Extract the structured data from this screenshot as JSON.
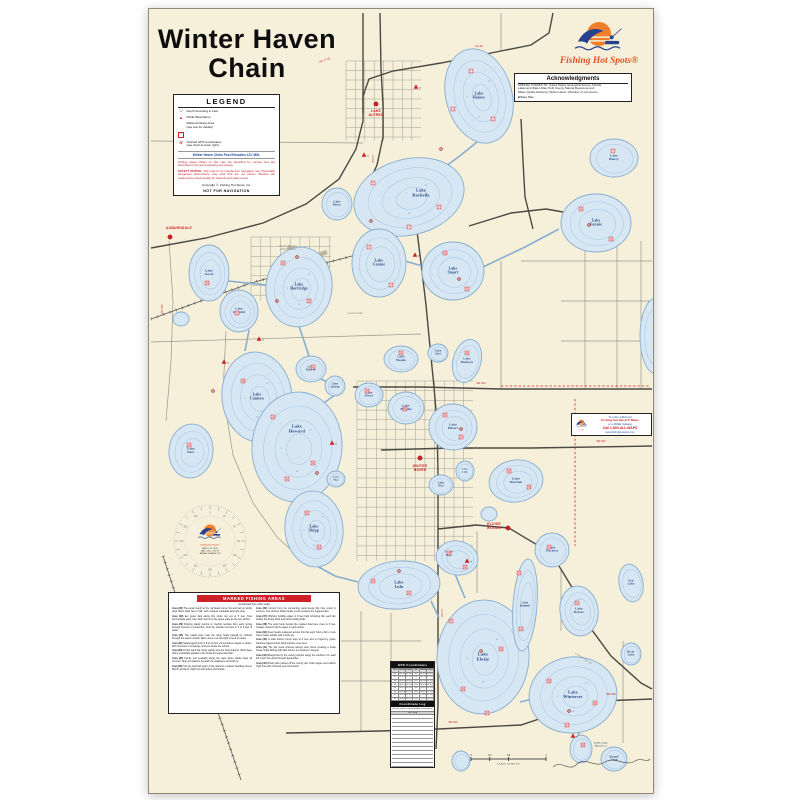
{
  "title": {
    "line1": "Winter Haven",
    "line2": "Chain"
  },
  "brand": {
    "name": "Fishing Hot Spots®"
  },
  "colors": {
    "accent_red": "#cf2027",
    "navy": "#1c3f77",
    "lake_fill": "#d7e6f3",
    "lake_stroke": "#86aecf",
    "contour": "#abc8e1",
    "cream": "#f6f0da",
    "brand_orange": "#ef7f2a",
    "brand_blue": "#27418e"
  },
  "legend": {
    "title": "LEGEND",
    "items": [
      {
        "icon": "sounding-icon",
        "label": "Depth Sounding in Feet"
      },
      {
        "icon": "boat-ramp-icon",
        "label": "Public Boat Ramp"
      },
      {
        "icon": "fishing-area-icon",
        "label": "Marked Fishing Area\n(see text for details)"
      },
      {
        "icon": "gps-point-icon",
        "label": "Charted GPS Coordinates\n(see chart at lower right)"
      }
    ],
    "pool": "Winter Haven Chain Pool Elevation 131' MSL",
    "note": "Fishing areas shown on this map are identified by number and are described in the accompanying text panels.",
    "safety_label": "SAFETY NOTICE:",
    "safety": " This map is not intended for navigation use. Potentially dangerous obstructions may exist that are not shown. Boaters are cautioned to check locally for hazards and water levels.",
    "copyright": "Copyright ©, Fishing Hot Spots, Inc.",
    "not_for_navigation": "NOT FOR NAVIGATION"
  },
  "acknowledgments": {
    "title": "Acknowledgments",
    "lines": [
      "SPECIAL THANKS TO: United States Geological Survey; Florida",
      "Lakes and Water Atlas; Polk County Natural Resources and",
      "Water Quality Divisions; Winter Haven Chamber of Commerce."
    ],
    "bullet": "■ Base Map"
  },
  "order_box": {
    "lines": [
      "To order additional",
      "Fishing Hot Spots® Maps",
      "or a FREE Catalog",
      "Call 1-800-ALL-MAPS",
      "www.fishinghotspots.com"
    ]
  },
  "compass": {
    "degrees": [
      "0",
      "30",
      "60",
      "90",
      "120",
      "150",
      "180",
      "210",
      "240",
      "270",
      "300",
      "330"
    ],
    "lines": [
      "MAP IS U.S. GRID",
      "MAG. DECL. 4°30' W",
      "ANNUAL CHANGE 2' W"
    ]
  },
  "scale_bar": {
    "caption": "SCALE IN MILES",
    "ticks": [
      "0",
      "1/4",
      "1/2",
      "1"
    ]
  },
  "marked_areas": {
    "header": "MARKED FISHING AREAS",
    "note": "(Continued from other side)",
    "paragraphs": [
      {
        "id": "Area (28)",
        "text": "The canal mouth at the northeast corner funnels bait on windy days. Bass stack here in fall; work a lipless crankbait along the drop."
      },
      {
        "id": "Area (29)",
        "text": "Eel grass flats along this shore top out at 5 feet. Toss spinnerbaits early, then pitch worms to the grass edge as the sun climbs."
      },
      {
        "id": "Area (30)",
        "text": "Flipping plastic worms or crayfish replicas from early spring through summer is productive. Fish the outside reed line in 4 to 6 feet of water."
      },
      {
        "id": "Area (31)",
        "text": "The cattail point near the ramp holds bluegill on crickets through the warm months. Bass move in at first light to feed on shad."
      },
      {
        "id": "Area (32)",
        "text": "Submerged brush in 8 to 10 feet concentrates crappie in winter. Drift minnows or small jigs until you locate the school."
      },
      {
        "id": "Area (33)",
        "text": "A hard sand bar drops quickly into the boat channel. Work deep diving crankbaits parallel to the break for suspended fish."
      },
      {
        "id": "Area (34)",
        "text": "Docks and seawalls along the west shore shade bass all summer. Skip soft plastics beneath the walkways and hold on."
      },
      {
        "id": "Area (35)",
        "text": "The lily pad field south of the island is a classic bedding area in March and April. Sight fish with tubes and lizards."
      },
      {
        "id": "Area (36)",
        "text": "Current from the connecting canal keeps this hole cooler in summer. Live shiners drifted under a cork produce the biggest bass."
      },
      {
        "id": "Area (37)",
        "text": "Offshore hydrilla edges in 9 feet hold schooling fish each fall. Follow the diving birds and throw rattling baits."
      },
      {
        "id": "Area (38)",
        "text": "The spoil bank beside the marked boat lane rises to 3 feet. Crappie suspend off its edges in early winter."
      },
      {
        "id": "Area (39)",
        "text": "Reed heads scattered across this flat each hold a fish or two. Cover water quickly with a swim jig."
      },
      {
        "id": "Area (40)",
        "text": "A shell bottom hump tops at 6 feet and is ringed by grass. Carolina rigged worms fished slowly score here."
      },
      {
        "id": "Area (41)",
        "text": "The old creek channel swings near shore creating a sharp break. Night fishing with dark worms is excellent in August."
      },
      {
        "id": "Area (42)",
        "text": "Bluegill bed in the sandy pockets along the southern rim each full moon from April through September."
      },
      {
        "id": "Area (43)",
        "text": "Brush piles placed off the county pier hold crappie and catfish. Tight line with minnows near the bottom."
      }
    ]
  },
  "gps": {
    "header": "GPS Coordinates",
    "columns": [
      "Sym",
      "Latitude",
      "Longitude",
      "Sym",
      "Latitude",
      "Longitude"
    ],
    "rows": [
      [
        "W1",
        "28°07.42'",
        "81°43.11'",
        "W9",
        "28°02.33'",
        "81°42.08'"
      ],
      [
        "W2",
        "28°06.91'",
        "81°42.57'",
        "W10",
        "28°01.87'",
        "81°41.95'"
      ],
      [
        "W3",
        "28°06.30'",
        "81°44.02'",
        "W11",
        "28°01.42'",
        "81°43.36'"
      ],
      [
        "W4",
        "28°05.78'",
        "81°41.66'",
        "W12",
        "28°00.98'",
        "81°42.71'"
      ],
      [
        "W5",
        "28°05.12'",
        "81°43.48'",
        "W13",
        "28°00.55'",
        "81°41.27'"
      ],
      [
        "W6",
        "28°04.66'",
        "81°42.19'",
        "W14",
        "28°00.12'",
        "81°42.90'"
      ],
      [
        "W7",
        "28°03.89'",
        "81°44.25'",
        "W15",
        "27°59.67'",
        "81°41.58'"
      ],
      [
        "W8",
        "28°03.21'",
        "81°43.74'",
        "W16",
        "27°59.20'",
        "81°42.33'"
      ]
    ],
    "log_header": "Coordinate Log",
    "log_note": "(use this space to record additional coordinates)",
    "log_column": "Lat / Long",
    "blank_rows": 13
  },
  "map": {
    "depth_labels": [
      "5",
      "10",
      "15"
    ],
    "lakes": [
      {
        "L": [
          "Lake",
          "Haines"
        ],
        "x": 330,
        "y": 87,
        "rx": 33,
        "ry": 48,
        "rot": -15,
        "c": 3
      },
      {
        "L": [
          "Lake",
          "Henry"
        ],
        "x": 465,
        "y": 149,
        "rx": 24,
        "ry": 19,
        "c": 1,
        "fs": 3.2
      },
      {
        "L": [
          "Lake",
          "Rochelle"
        ],
        "x": 260,
        "y": 188,
        "rx": 56,
        "ry": 38,
        "rot": -14,
        "c": 3,
        "fs": 4.2,
        "lx": 272,
        "ly": 184
      },
      {
        "L": [
          "Lake",
          "Conine"
        ],
        "x": 230,
        "y": 254,
        "rx": 27,
        "ry": 34,
        "c": 2
      },
      {
        "L": [
          "Lake",
          "Smart"
        ],
        "x": 304,
        "y": 262,
        "rx": 31,
        "ry": 29,
        "c": 2
      },
      {
        "L": [
          "Lake",
          "Fannie"
        ],
        "x": 447,
        "y": 214,
        "rx": 35,
        "ry": 29,
        "c": 2
      },
      {
        "L": [
          "Lake",
          "Pansy"
        ],
        "x": 188,
        "y": 195,
        "rx": 15,
        "ry": 16,
        "c": 1,
        "fs": 2.8
      },
      {
        "L": [
          "Lake",
          "Jessie"
        ],
        "x": 60,
        "y": 264,
        "rx": 20,
        "ry": 28,
        "c": 2,
        "fs": 3.2
      },
      {
        "L": [
          "Lake",
          "Idylwild"
        ],
        "x": 90,
        "y": 302,
        "rx": 19,
        "ry": 21,
        "c": 2,
        "fs": 3
      },
      {
        "L": [
          "Lake",
          "Hartridge"
        ],
        "x": 150,
        "y": 278,
        "rx": 33,
        "ry": 40,
        "rot": 8,
        "c": 3
      },
      {
        "L": [
          "Lake",
          "Cannon"
        ],
        "x": 108,
        "y": 388,
        "rx": 35,
        "ry": 45,
        "rot": -6,
        "c": 3
      },
      {
        "L": [
          "Lake",
          "Mirror"
        ],
        "x": 162,
        "y": 360,
        "rx": 15,
        "ry": 13,
        "c": 1,
        "fs": 2.8
      },
      {
        "L": [
          "Lake",
          "Spring"
        ],
        "x": 186,
        "y": 377,
        "rx": 10,
        "ry": 10,
        "c": 1,
        "fs": 2.6
      },
      {
        "L": [
          "Lake",
          "Silver"
        ],
        "x": 220,
        "y": 386,
        "rx": 14,
        "ry": 12,
        "c": 1,
        "fs": 2.8
      },
      {
        "L": [
          "Lake",
          "Howard"
        ],
        "x": 148,
        "y": 438,
        "rx": 45,
        "ry": 55,
        "rot": 4,
        "c": 3,
        "fs": 4.2,
        "ly": 420
      },
      {
        "L": [
          "Lake",
          "Maude"
        ],
        "x": 252,
        "y": 350,
        "rx": 17,
        "ry": 13,
        "c": 1,
        "fs": 2.9
      },
      {
        "L": [
          "Lake",
          "Idyl"
        ],
        "x": 289,
        "y": 344,
        "rx": 10,
        "ry": 9,
        "c": 1,
        "fs": 2.6
      },
      {
        "L": [
          "Lake",
          "Buckeye"
        ],
        "x": 318,
        "y": 352,
        "rx": 14,
        "ry": 22,
        "rot": 15,
        "c": 1,
        "fs": 2.9
      },
      {
        "L": [
          "Lake",
          "Martha"
        ],
        "x": 257,
        "y": 399,
        "rx": 18,
        "ry": 16,
        "c": 1,
        "fs": 3
      },
      {
        "L": [
          "Lake",
          "Elbert"
        ],
        "x": 304,
        "y": 418,
        "rx": 24,
        "ry": 23,
        "c": 2,
        "fs": 3.2
      },
      {
        "L": [
          "Lake",
          "Link"
        ],
        "x": 316,
        "y": 462,
        "rx": 9,
        "ry": 10,
        "c": 1,
        "fs": 2.5
      },
      {
        "L": [
          "Lake",
          "Otis"
        ],
        "x": 292,
        "y": 476,
        "rx": 12,
        "ry": 10,
        "c": 1,
        "fs": 2.6
      },
      {
        "L": [
          "Lake",
          "Mariam"
        ],
        "x": 367,
        "y": 472,
        "rx": 27,
        "ry": 21,
        "rot": -8,
        "c": 2,
        "fs": 3.2
      },
      {
        "L": [
          "Lake",
          "Shipp"
        ],
        "x": 165,
        "y": 520,
        "rx": 29,
        "ry": 38,
        "rot": -6,
        "c": 3
      },
      {
        "L": [
          "Lake",
          "May"
        ],
        "x": 187,
        "y": 470,
        "rx": 9,
        "ry": 8,
        "c": 1,
        "fs": 2.5
      },
      {
        "L": [
          "Lake",
          "Lulu"
        ],
        "x": 250,
        "y": 576,
        "rx": 41,
        "ry": 24,
        "rot": -4,
        "c": 2,
        "fs": 3.8
      },
      {
        "L": [
          "Lake",
          "Roy"
        ],
        "x": 308,
        "y": 549,
        "rx": 21,
        "ry": 17,
        "rot": 10,
        "c": 2,
        "fs": 3,
        "lx": 300,
        "ly": 545
      },
      {
        "L": [
          "Lake",
          "Eloise"
        ],
        "x": 334,
        "y": 648,
        "rx": 46,
        "ry": 57,
        "rot": 3,
        "c": 4,
        "fs": 4.4
      },
      {
        "L": [
          "Lake",
          "Summit"
        ],
        "x": 376,
        "y": 596,
        "rx": 12,
        "ry": 46,
        "rot": 4,
        "c": 2,
        "fs": 2.7
      },
      {
        "L": [
          "Lake",
          "Florence"
        ],
        "x": 403,
        "y": 541,
        "rx": 17,
        "ry": 17,
        "c": 1,
        "fs": 2.8
      },
      {
        "L": [
          "Lake",
          "Dexter"
        ],
        "x": 430,
        "y": 602,
        "rx": 19,
        "ry": 25,
        "rot": -8,
        "c": 2,
        "fs": 3
      },
      {
        "L": [
          "Ned",
          "Lake"
        ],
        "x": 482,
        "y": 574,
        "rx": 12,
        "ry": 19,
        "rot": -10,
        "c": 1,
        "fs": 2.7
      },
      {
        "L": [
          "River",
          "Lake"
        ],
        "x": 482,
        "y": 645,
        "rx": 10,
        "ry": 11,
        "c": 1,
        "fs": 2.6
      },
      {
        "L": [
          "Lake",
          "Winterset"
        ],
        "x": 424,
        "y": 686,
        "rx": 44,
        "ry": 38,
        "rot": -8,
        "c": 3,
        "fs": 4
      },
      {
        "L": [
          "Little Lake",
          "Winterset"
        ],
        "x": 432,
        "y": 740,
        "rx": 11,
        "ry": 14,
        "c": 1,
        "fs": 2.4,
        "lx": 452,
        "ly": 736
      },
      {
        "L": [
          "Round",
          "Lake"
        ],
        "x": 465,
        "y": 750,
        "rx": 13,
        "ry": 12,
        "c": 1,
        "fs": 2.7
      },
      {
        "L": [
          "Lake",
          "Deer"
        ],
        "x": 42,
        "y": 442,
        "rx": 22,
        "ry": 27,
        "rot": 6,
        "c": 2,
        "fs": 3
      },
      {
        "x": 507,
        "y": 327,
        "rx": 16,
        "ry": 38,
        "c": 1
      },
      {
        "x": 32,
        "y": 310,
        "rx": 8,
        "ry": 7,
        "c": 0
      },
      {
        "x": 312,
        "y": 752,
        "rx": 9,
        "ry": 10,
        "c": 1
      },
      {
        "x": 340,
        "y": 505,
        "rx": 8,
        "ry": 7,
        "c": 0
      }
    ],
    "canals": [
      "328,133 312,146 296,158",
      "249,222 236,221",
      "256,252 273,257",
      "334,258 376,238 410,220",
      "79,272 117,276",
      "100,321 96,342",
      "150,317 160,347",
      "168,368 178,373",
      "186,386 172,396",
      "150,491 158,484",
      "166,556 186,567 209,573",
      "306,565 316,589",
      "282,592 290,609",
      "378,627 364,612",
      "430,726 428,720",
      "371,693 384,690"
    ],
    "red_dashes": [
      [
        352,
        377,
        500,
        377
      ],
      [
        426,
        390,
        426,
        537
      ]
    ],
    "cities": [
      {
        "name": "AUBURNDALE",
        "lines": [
          "AUBURNDALE"
        ],
        "x": 21,
        "y": 228,
        "lx": 30,
        "ly": 220
      },
      {
        "name": "LAKE ALFRED",
        "lines": [
          "LAKE",
          "ALFRED"
        ],
        "x": 227,
        "y": 95,
        "lx": 227,
        "ly": 103
      },
      {
        "name": "WINTER HAVEN",
        "lines": [
          "WINTER",
          "HAVEN"
        ],
        "x": 271,
        "y": 449,
        "lx": 271,
        "ly": 458
      },
      {
        "name": "ELOISE WOODS",
        "lines": [
          "ELOISE",
          "WOODS"
        ],
        "x": 359,
        "y": 519,
        "lx": 345,
        "ly": 516
      }
    ],
    "gray_labels": [
      {
        "lines": [
          "Winter Haven's",
          "Gilbert Airport"
        ],
        "x": 139,
        "y": 238
      },
      {
        "lines": [
          "Lucerne Park"
        ],
        "x": 206,
        "y": 305
      },
      {
        "lines": [
          "Lucerne Park Rd"
        ],
        "x": 434,
        "y": 650,
        "rot": 34
      }
    ],
    "road_labels": [
      {
        "t": "US 17-92",
        "x": 176,
        "y": 52,
        "rot": -18
      },
      {
        "t": "US 92",
        "x": 330,
        "y": 38
      },
      {
        "t": "US 17",
        "x": 225,
        "y": 150,
        "rot": -90
      },
      {
        "t": "US 17",
        "x": 294,
        "y": 604,
        "rot": -90
      },
      {
        "t": "SR 544",
        "x": 332,
        "y": 375
      },
      {
        "t": "SR 542",
        "x": 452,
        "y": 433
      },
      {
        "t": "SR 540",
        "x": 304,
        "y": 714
      },
      {
        "t": "SR 540",
        "x": 462,
        "y": 686
      },
      {
        "t": "CR 655",
        "x": 14,
        "y": 300,
        "rot": -90
      }
    ],
    "ramps": [
      [
        267,
        78
      ],
      [
        215,
        146
      ],
      [
        266,
        246
      ],
      [
        75,
        353
      ],
      [
        183,
        434
      ],
      [
        318,
        552
      ],
      [
        424,
        727
      ],
      [
        110,
        330
      ]
    ],
    "areas": [
      [
        322,
        62
      ],
      [
        344,
        110
      ],
      [
        304,
        100
      ],
      [
        464,
        142
      ],
      [
        224,
        174
      ],
      [
        290,
        198
      ],
      [
        260,
        218
      ],
      [
        220,
        238
      ],
      [
        242,
        276
      ],
      [
        296,
        244
      ],
      [
        318,
        280
      ],
      [
        432,
        200
      ],
      [
        462,
        230
      ],
      [
        134,
        254
      ],
      [
        160,
        292
      ],
      [
        58,
        274
      ],
      [
        88,
        304
      ],
      [
        94,
        372
      ],
      [
        124,
        408
      ],
      [
        164,
        454
      ],
      [
        138,
        470
      ],
      [
        164,
        358
      ],
      [
        218,
        382
      ],
      [
        252,
        344
      ],
      [
        318,
        344
      ],
      [
        296,
        406
      ],
      [
        312,
        428
      ],
      [
        256,
        400
      ],
      [
        360,
        462
      ],
      [
        380,
        478
      ],
      [
        158,
        504
      ],
      [
        170,
        538
      ],
      [
        224,
        572
      ],
      [
        260,
        584
      ],
      [
        300,
        544
      ],
      [
        316,
        558
      ],
      [
        302,
        612
      ],
      [
        352,
        640
      ],
      [
        314,
        680
      ],
      [
        338,
        704
      ],
      [
        370,
        564
      ],
      [
        372,
        620
      ],
      [
        400,
        538
      ],
      [
        428,
        594
      ],
      [
        400,
        672
      ],
      [
        446,
        694
      ],
      [
        418,
        716
      ],
      [
        434,
        736
      ],
      [
        40,
        436
      ]
    ],
    "gps_points": [
      [
        292,
        140
      ],
      [
        222,
        212
      ],
      [
        148,
        248
      ],
      [
        310,
        270
      ],
      [
        128,
        292
      ],
      [
        64,
        382
      ],
      [
        168,
        464
      ],
      [
        250,
        562
      ],
      [
        332,
        642
      ],
      [
        420,
        702
      ],
      [
        312,
        420
      ],
      [
        440,
        216
      ]
    ],
    "airport_label": "+"
  }
}
